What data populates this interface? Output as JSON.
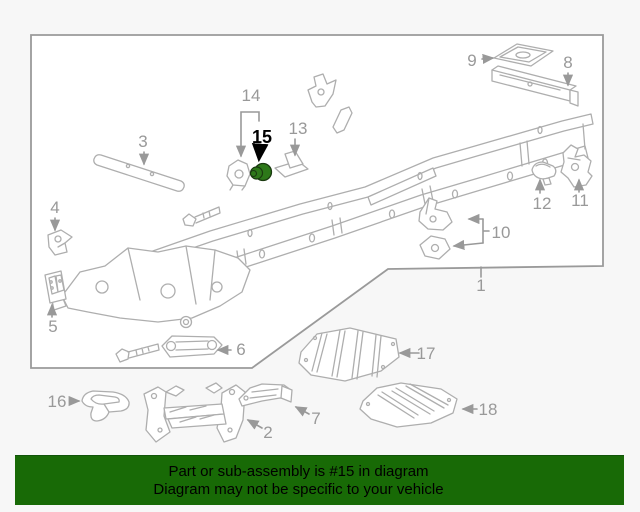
{
  "diagram": {
    "callouts": [
      {
        "label": "1"
      },
      {
        "label": "2"
      },
      {
        "label": "3"
      },
      {
        "label": "4"
      },
      {
        "label": "5"
      },
      {
        "label": "6"
      },
      {
        "label": "7"
      },
      {
        "label": "8"
      },
      {
        "label": "9"
      },
      {
        "label": "10"
      },
      {
        "label": "11"
      },
      {
        "label": "12"
      },
      {
        "label": "13"
      },
      {
        "label": "14"
      },
      {
        "label": "15",
        "highlighted": true
      },
      {
        "label": "16"
      },
      {
        "label": "17"
      },
      {
        "label": "18"
      }
    ],
    "highlighted_callout": "15",
    "highlight_color": "#2d7819",
    "label_color": "#999999",
    "line_color": "#aeaeae",
    "border_color": "#9a9a9a"
  },
  "banner": {
    "line1": "Part or sub-assembly is #15 in diagram",
    "line2": "Diagram may not be specific to your vehicle",
    "background_color": "#186a06",
    "text_color": "#000000"
  }
}
